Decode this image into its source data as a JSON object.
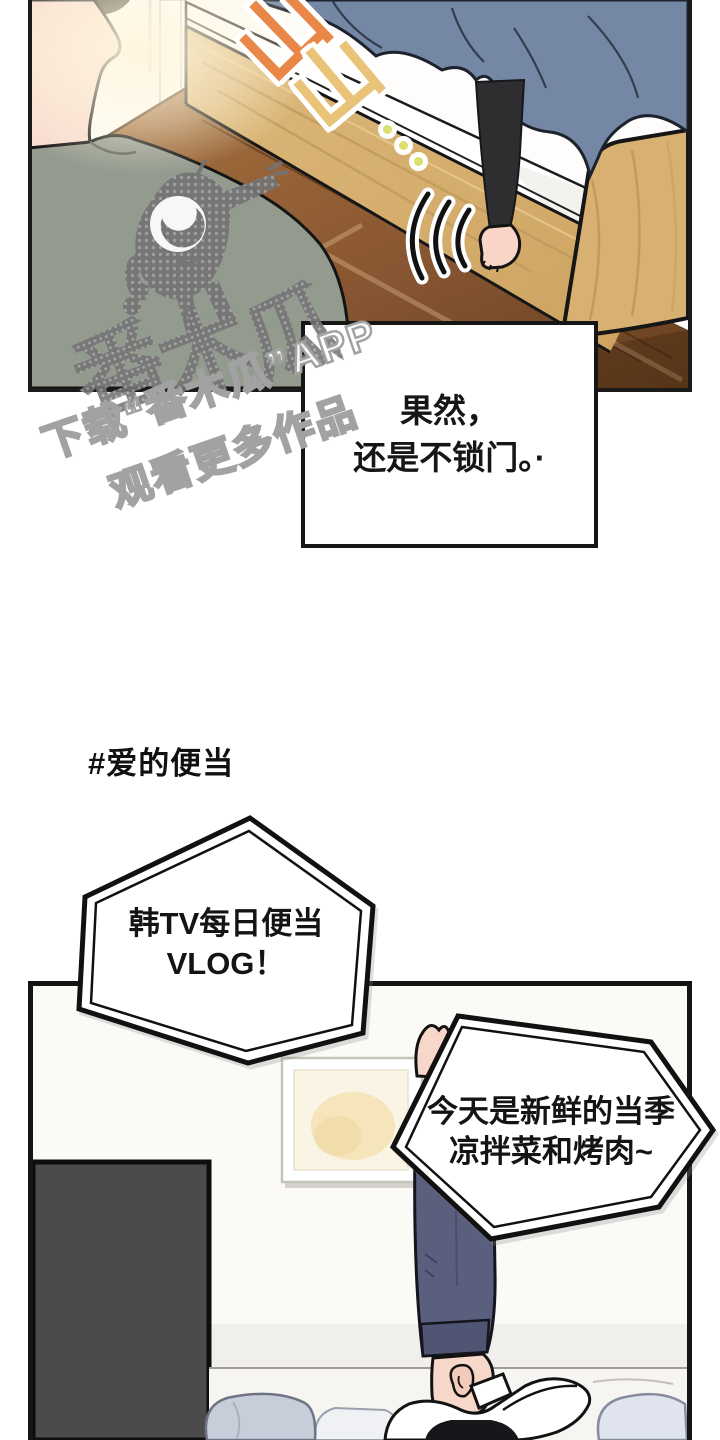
{
  "panel1": {
    "sfx": {
      "char1": "山",
      "char2": "山",
      "dots_count": 3
    },
    "scene": "bedroom with bed, blanket, leg stepping down to wood floor, watcher in foreground"
  },
  "speech1": {
    "lines": {
      "l1": "果然，",
      "l2": "还是不锁门。·"
    }
  },
  "watermark": {
    "big_chars": {
      "c1": "番",
      "c2": "木",
      "c3": "瓜"
    },
    "caption_line1": "下载“番木瓜”APP",
    "caption_line2": "观看更多作品",
    "mascot": "papaya-mascot"
  },
  "hashtag": "#爱的便当",
  "bubble1": {
    "l1": "韩TV每日便当",
    "l2": "VLOG！"
  },
  "bubble2": {
    "l1": "今天是新鲜的当季",
    "l2": "凉拌菜和烤肉~"
  },
  "colors": {
    "sfx_orange": "#e98748",
    "sfx_yellow": "#e9c478",
    "sfx_dot": "#d9e06e",
    "blanket": "#7488a5",
    "bed_wood": "#d9b274",
    "floor_wood": "#8a5733",
    "shirt": "#939a8e",
    "skin": "#f8dcd0",
    "pants_navy": "#5b5f7e",
    "dark_panel": "#4b4b4b",
    "pillow": "#c7ceda",
    "line": "#141414"
  }
}
